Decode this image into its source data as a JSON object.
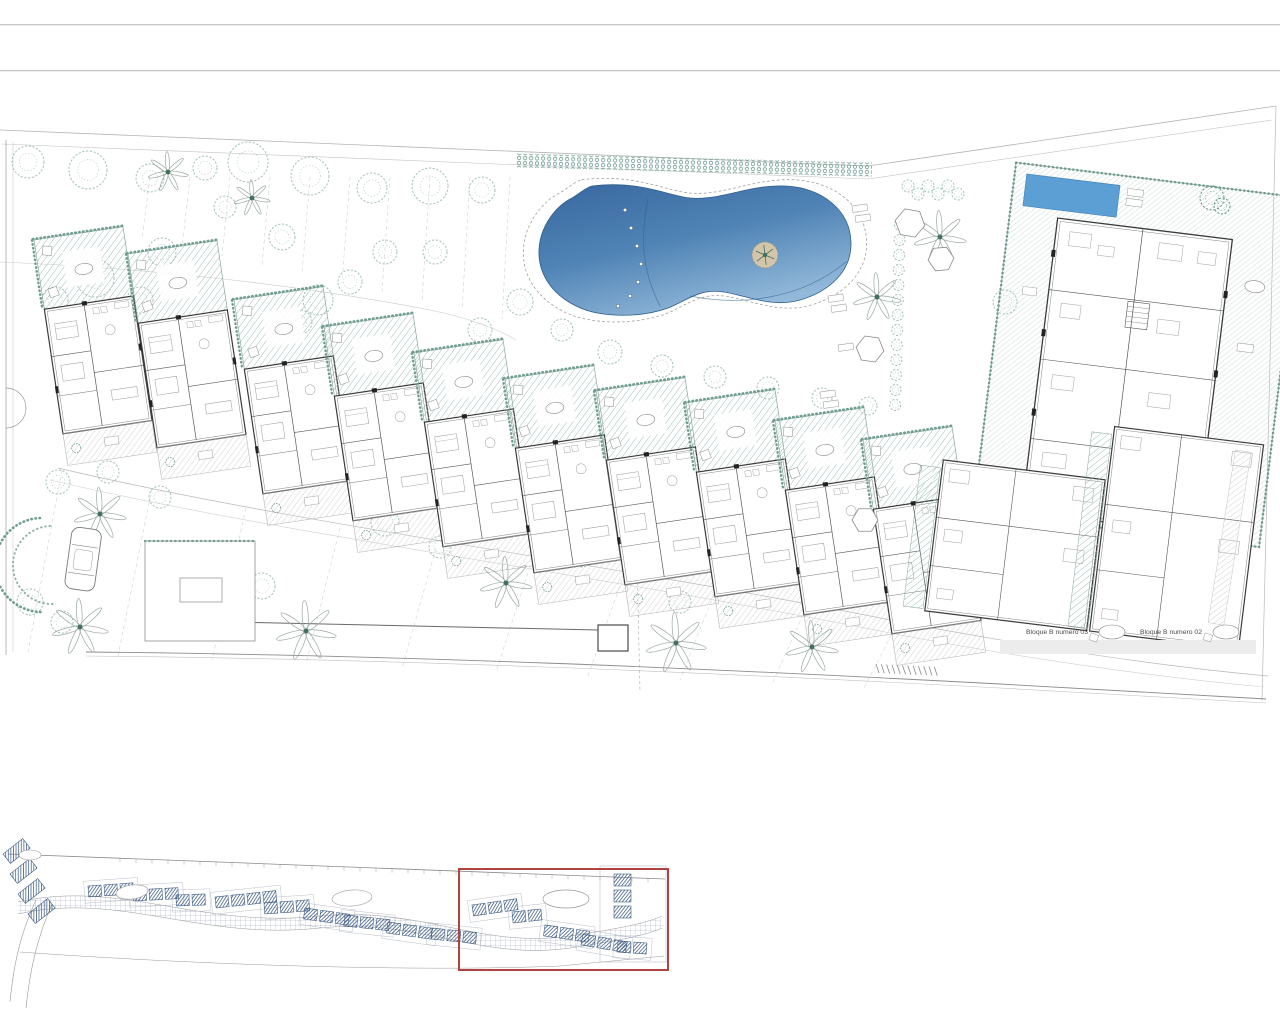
{
  "header": {
    "divider_top": "header-divider",
    "divider_bottom": "toolbar-divider"
  },
  "site_plan": {
    "labels": {
      "block_03": "Bloque B numero 03",
      "block_02": "Bloque B numero 02"
    },
    "features": {
      "main_pool": "swimming-pool",
      "pool_island": "pool-palm-island",
      "lap_pool": "rooftop-lap-pool",
      "car": "parked-car",
      "cascade": "terraced-apartment-row",
      "right_block": "apartment-block-b",
      "vegetation": "trees-and-palms"
    }
  },
  "key_plan": {
    "name": "overview-key-plan",
    "highlight": "current-section-highlight"
  },
  "colors": {
    "accent_red": "#b04240",
    "pool_dark": "#38679f",
    "pool_mid": "#4f83b5",
    "pool_light": "#93b9da",
    "pool_flat": "#5b9fd4",
    "hatch_teal": "#9dbfb6",
    "hatch_teal_light": "#bcd3cc",
    "hedge_teal": "#6f9d92",
    "tree_green": "#a3c2b8",
    "palm_green": "#41705f",
    "wall_dark": "#3c3c3c",
    "line_gray": "#9a9a9a",
    "hatch_gray": "#cccccc",
    "keyplan_navy": "#3f5c84",
    "sand": "#d2c5a9"
  }
}
